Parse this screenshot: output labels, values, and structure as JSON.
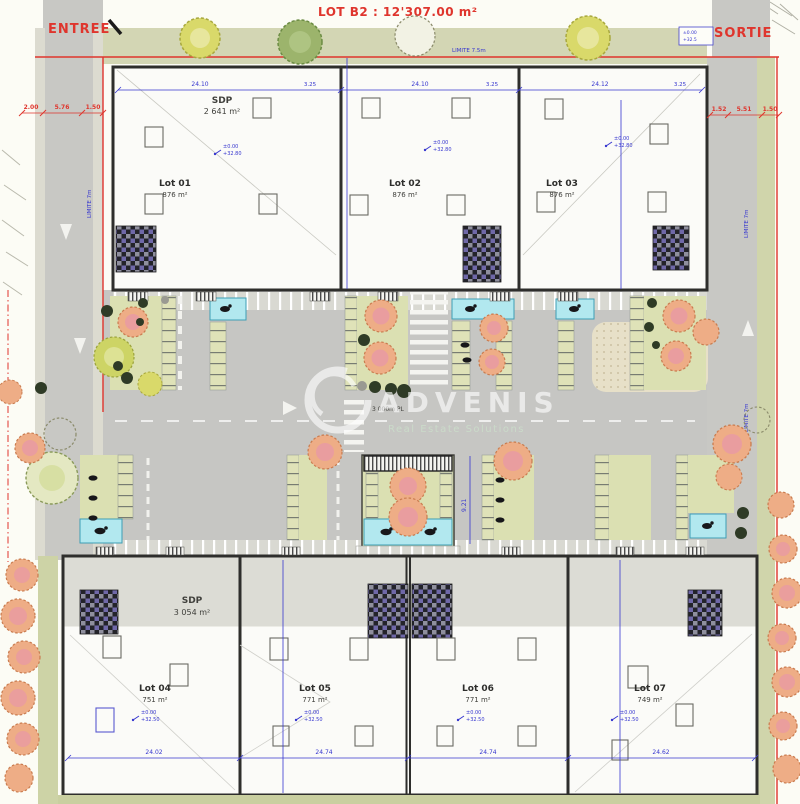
{
  "plan": {
    "title": "LOT B2 : 12'307.00 m²",
    "entree_label": "ENTREE",
    "sortie_label": "SORTIE",
    "watermark": {
      "name": "ADVENIS",
      "tagline": "Real Estate Solutions"
    },
    "road_label": "3 000m PL",
    "limits": {
      "top": "LIMITE 7.5m",
      "left": "LIMITE 7m",
      "right": "LIMITE 7m"
    },
    "levels": {
      "ground": "±0.00",
      "roof_top": "+32.80",
      "roof_bottom": "+32.50",
      "gate": "+32.5"
    },
    "top_row": {
      "sdp_label": "SDP",
      "sdp_area": "2 641 m²",
      "lots": [
        {
          "name": "Lot 01",
          "area": "876 m²"
        },
        {
          "name": "Lot 02",
          "area": "876 m²"
        },
        {
          "name": "Lot 03",
          "area": "876 m²"
        }
      ]
    },
    "bottom_row": {
      "sdp_label": "SDP",
      "sdp_area": "3 054 m²",
      "lots": [
        {
          "name": "Lot 04",
          "area": "751 m²"
        },
        {
          "name": "Lot 05",
          "area": "771 m²"
        },
        {
          "name": "Lot 06",
          "area": "771 m²"
        },
        {
          "name": "Lot 07",
          "area": "749 m²"
        }
      ]
    },
    "dims": {
      "red_left": [
        "2.00",
        "5.76",
        "1.50"
      ],
      "red_right": [
        "1.52",
        "5.51",
        "1.50"
      ],
      "blue_top": [
        "24.10",
        "3.25",
        "24.10",
        "3.25",
        "24.12",
        "3.25"
      ],
      "blue_bottom": [
        "24.02",
        "24.74",
        "24.74",
        "24.62"
      ],
      "mid_vertical": "9.21"
    },
    "colors": {
      "boundary": "#df352d",
      "dimension": "#3636cf",
      "pmr_bay": "#b2e8ef"
    }
  }
}
